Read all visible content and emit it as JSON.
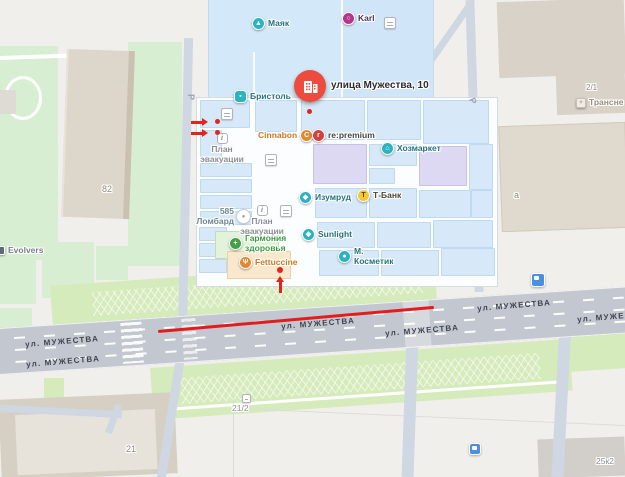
{
  "map_type": "city-map",
  "pin": {
    "label": "улица Мужества, 10"
  },
  "road": {
    "labels": [
      "ул. МУЖЕСТВА",
      "ул. МУЖЕСТВА",
      "ул. МУЖЕСТВА",
      "ул. МУЖЕСТВА",
      "ул. МУЖЕСТВА",
      "ул. МУЖЕСТВА"
    ]
  },
  "pois": [
    {
      "label": "Маяк",
      "glyph": "▲",
      "color": "#2ab3c0"
    },
    {
      "label": "Karl",
      "glyph": "○",
      "color": "#b5348e"
    },
    {
      "label": "Бристоль",
      "glyph": "▪",
      "color": "#2ab3c0"
    },
    {
      "label": "Cinnabon",
      "glyph": "C",
      "color": "#e2892f"
    },
    {
      "label": "re:premium",
      "glyph": "r",
      "color": "#d2413c"
    },
    {
      "label": "Хозмаркет",
      "glyph": "⌂",
      "color": "#2ab3c0"
    },
    {
      "label": "Изумруд",
      "glyph": "◆",
      "color": "#2ab3c0"
    },
    {
      "label": "Т-Банк",
      "glyph": "Т",
      "color": "#f6c932"
    },
    {
      "label": "Sunlight",
      "glyph": "◆",
      "color": "#2ab3c0"
    },
    {
      "label": "М. Косметик",
      "glyph": "●",
      "color": "#2ab3c0"
    },
    {
      "label": "Гармония здоровья",
      "glyph": "+",
      "color": "#43a047"
    },
    {
      "label": "Fettuccine",
      "glyph": "Ψ",
      "color": "#e2892f"
    },
    {
      "label": "585 Ломбард",
      "glyph": "●",
      "color": "#ffffff"
    },
    {
      "label": "План эвакуации",
      "glyph": "i",
      "color": "#ffffff"
    },
    {
      "label": "План эвакуации",
      "glyph": "i",
      "color": "#ffffff"
    },
    {
      "label": "Трансне",
      "glyph": "+",
      "color": "#efece6"
    },
    {
      "label": "Evolvers",
      "glyph": "",
      "color": "#5f6a75"
    }
  ],
  "buildings": {
    "left": "82",
    "top_right": "2/1",
    "right": "а",
    "bottom_left": "21",
    "bottom_mid": "21/2",
    "bottom_right": "25к2"
  },
  "parking": {
    "label": "Р"
  },
  "colors": {
    "pin_red": "#ee4b3f",
    "annotation_red": "#e0251f",
    "poi_teal": "#2ab3c0",
    "poi_orange": "#e2892f",
    "poi_magenta": "#b5348e",
    "poi_yellow": "#f6c932",
    "poi_green": "#43a047",
    "poi_red": "#d2413c",
    "road_gray": "#c3c7cf",
    "mall_blue": "#d7e9f8",
    "mall_purple": "#ded9f3",
    "lawn_green": "#d6ebbc",
    "park_green": "#d7eed3",
    "building_beige": "#ddd6cb",
    "bus_blue": "#4a8fe0"
  }
}
